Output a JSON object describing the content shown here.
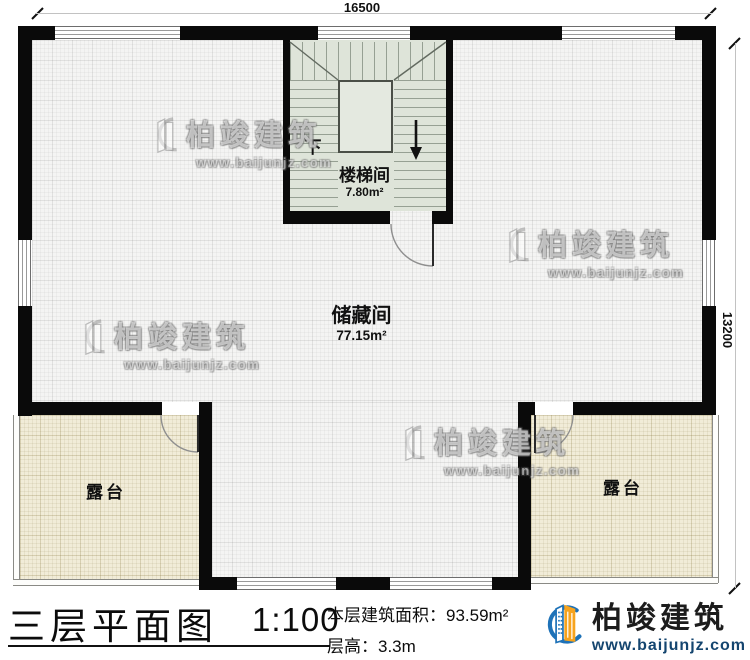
{
  "plan": {
    "dim_width": "16500",
    "dim_height": "13200",
    "rooms": {
      "stairwell": {
        "name": "楼梯间",
        "area": "7.80m²",
        "down": "下"
      },
      "storage": {
        "name": "储藏间",
        "area": "77.15m²"
      },
      "terrace_left": {
        "name": "露台"
      },
      "terrace_right": {
        "name": "露台"
      }
    }
  },
  "footer": {
    "title": "三层平面图",
    "scale": "1:100",
    "area_line": "本层建筑面积：93.59m²",
    "height_line": "层高：3.3m"
  },
  "brand": {
    "name": "柏竣建筑",
    "url": "www.baijunjz.com"
  },
  "watermark": {
    "name": "柏竣建筑",
    "url": "www.baijunjz.com"
  },
  "colors": {
    "wall": "#0a0a0a",
    "stair_floor": "#dee4d9",
    "terrace": "#f1ecd8",
    "brand_blue": "#1e72b8",
    "brand_orange": "#f7a31d"
  }
}
